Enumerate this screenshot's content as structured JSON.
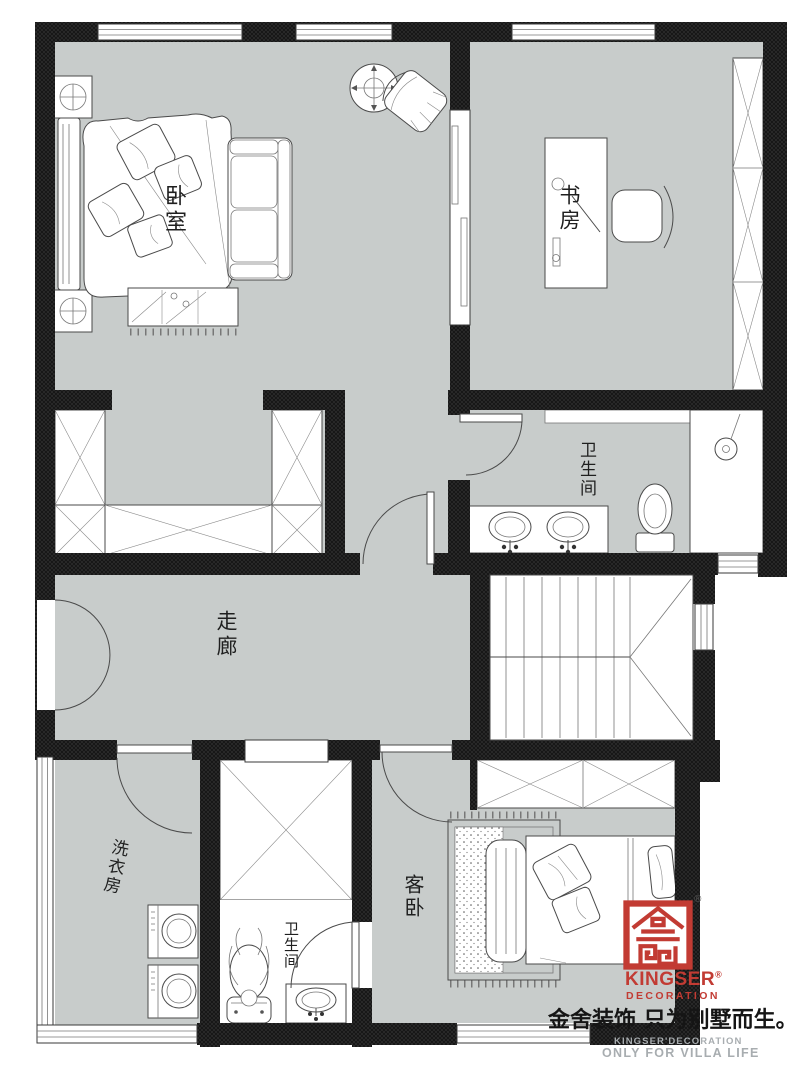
{
  "plan": {
    "rooms": [
      {
        "id": "master-bedroom",
        "label": "卧室"
      },
      {
        "id": "study",
        "label": "书房"
      },
      {
        "id": "master-bathroom",
        "label": "卫生间"
      },
      {
        "id": "corridor",
        "label": "走廊"
      },
      {
        "id": "laundry-room",
        "label": "洗衣房"
      },
      {
        "id": "small-bathroom",
        "label": "卫生间"
      },
      {
        "id": "guest-bedroom",
        "label": "客卧"
      }
    ]
  },
  "branding": {
    "brand_name": "KINGSER",
    "brand_division": "DECORATION",
    "registered_mark": "®",
    "slogan_cn": "金舍装饰 只为别墅而生。",
    "watermark_brand": "KINGSER'DECORATION",
    "watermark_tagline": "ONLY FOR VILLA LIFE"
  },
  "colors": {
    "floor_grey": "#c8cccb",
    "wall_black": "#161616",
    "brand_red": "#c23b33",
    "watermark_grey": "#a8adb0",
    "line_grey": "#555555"
  }
}
